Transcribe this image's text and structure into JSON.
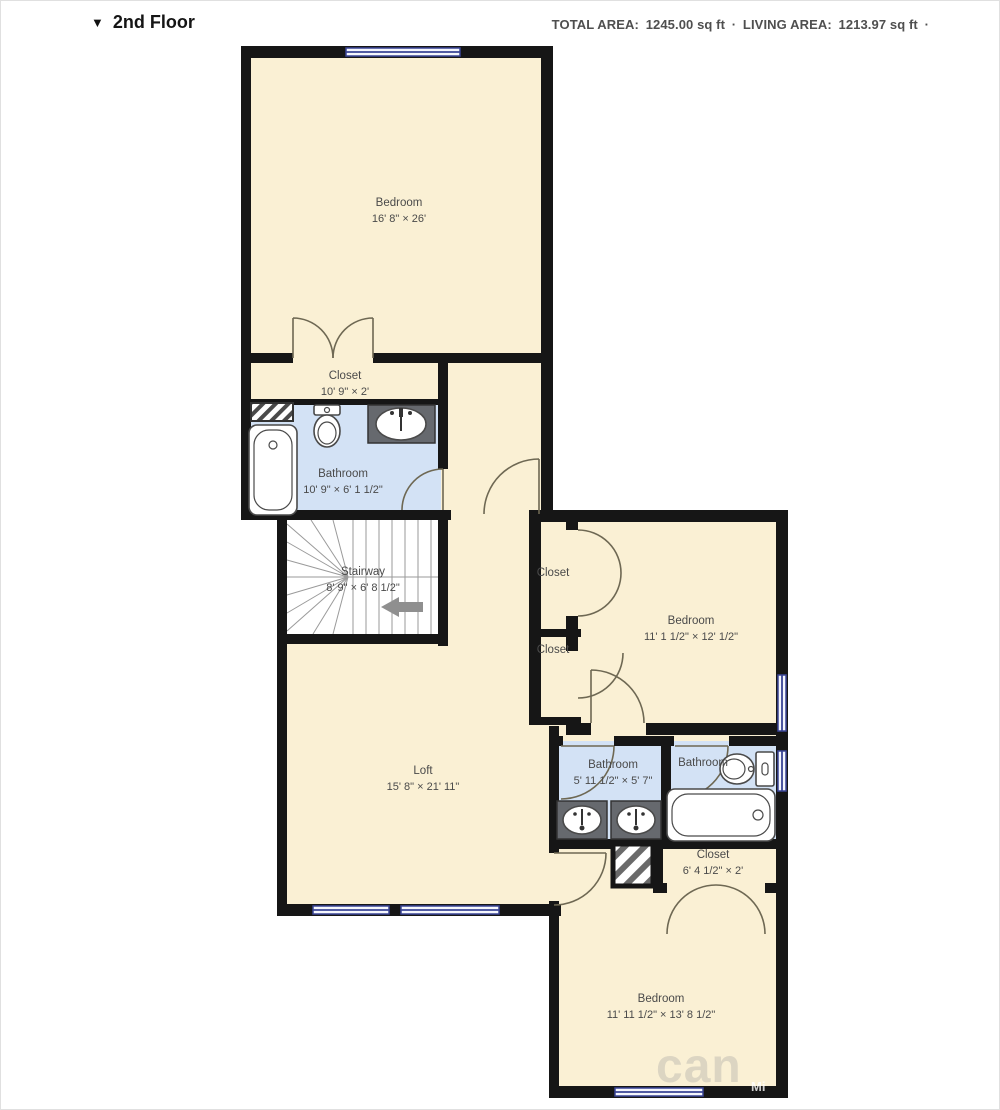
{
  "header": {
    "collapse_icon": "▼",
    "title": "2nd Floor",
    "total_area_label": "TOTAL AREA:",
    "total_area_value": "1245.00 sq ft",
    "separator": "·",
    "living_area_label": "LIVING AREA:",
    "living_area_value": "1213.97 sq ft",
    "trailing_separator": "·"
  },
  "colors": {
    "wall": "#161616",
    "room_fill": "#faf0d4",
    "bathroom_fill": "#d3e2f5",
    "window_accent": "#3a4596"
  },
  "rooms": {
    "bedroom_main": {
      "name": "Bedroom",
      "dims": "16' 8\" × 26'"
    },
    "closet_main": {
      "name": "Closet",
      "dims": "10' 9\" × 2'"
    },
    "bathroom_main": {
      "name": "Bathroom",
      "dims": "10' 9\" × 6' 1 1/2\""
    },
    "stairway": {
      "name": "Stairway",
      "dims": "8' 9\" × 6' 8 1/2\""
    },
    "closet_hall_upper": {
      "name": "Closet"
    },
    "closet_hall_lower": {
      "name": "Closet"
    },
    "bedroom_right": {
      "name": "Bedroom",
      "dims": "11' 1 1/2\" × 12' 1/2\""
    },
    "loft": {
      "name": "Loft",
      "dims": "15' 8\" × 21' 11\""
    },
    "bathroom_hall": {
      "name": "Bathroom",
      "dims": "5' 11 1/2\" × 5' 7\""
    },
    "bathroom_ensuite": {
      "name": "Bathroom"
    },
    "closet_rear": {
      "name": "Closet",
      "dims": "6' 4 1/2\" × 2'"
    },
    "bedroom_rear": {
      "name": "Bedroom",
      "dims": "11' 11 1/2\" × 13' 8 1/2\""
    }
  },
  "watermark": {
    "logo_text": "can",
    "wall_text": "Mi"
  }
}
